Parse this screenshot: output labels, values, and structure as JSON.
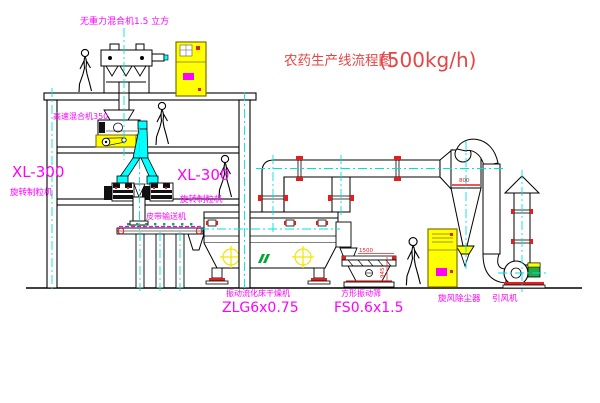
{
  "title": {
    "prefix": "农药生产线流程图",
    "capacity": "(500kg/h)"
  },
  "equipment": {
    "gravity_free_mixer": {
      "label": "无重力混合机1.5 立方"
    },
    "high_speed_mixer": {
      "label": "高速混合机350"
    },
    "granulator_left": {
      "model": "XL-300",
      "name": "旋转制粒机"
    },
    "granulator_right": {
      "model": "XL-300",
      "name": "旋转制粒机"
    },
    "belt_conveyor": {
      "name": "皮带输送机"
    },
    "fluid_bed_dryer": {
      "name": "振动流化床干燥机",
      "model": "ZLG6x0.75"
    },
    "square_vibrating_screen": {
      "name": "方形振动筛",
      "model": "FS0.6x1.5"
    },
    "cyclone": {
      "name": "旋风除尘器"
    },
    "induced_draft_fan": {
      "name": "引风机"
    }
  },
  "dimensions": {
    "screen_length": "1500",
    "screen_side": "945",
    "cyclone_width": "800"
  },
  "colors": {
    "label_magenta": "#ff00ff",
    "title_red": "#e64545",
    "dim_red": "#e02020",
    "equipment_yellow": "#ffff00",
    "centerline_cyan": "#00e0e0",
    "chute_cyan": "#00ffff",
    "logo_green": "#00a532",
    "line_black": "#000000"
  }
}
